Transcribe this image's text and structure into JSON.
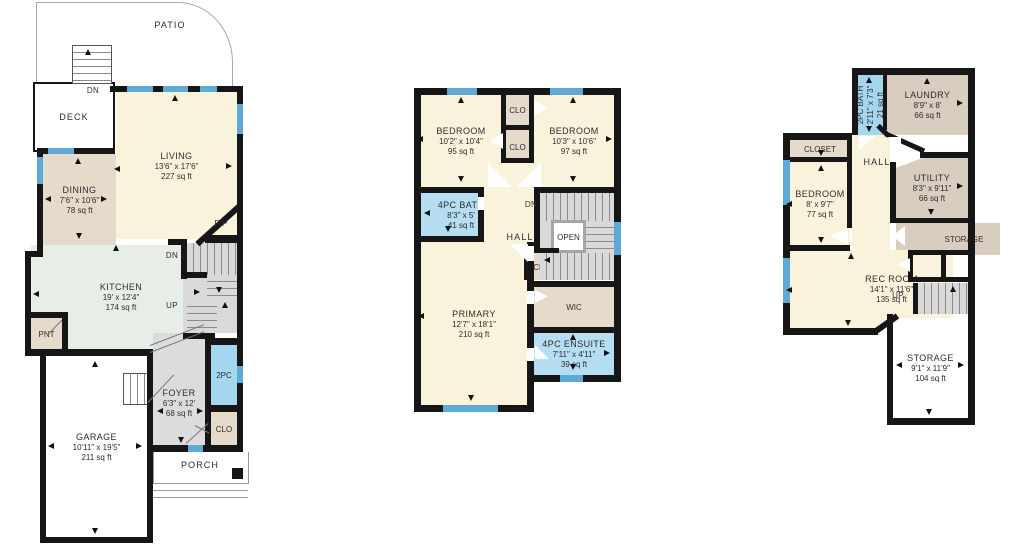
{
  "colors": {
    "wall": "#161616",
    "window": "#5FA9D6",
    "room_cream": "#FAF3DC",
    "room_tan": "#E6DACB",
    "room_taupe": "#D9CDBF",
    "room_kitchen": "#E7EEE7",
    "room_gray": "#DCDCDC",
    "room_blue": "#B5DEF2",
    "room_blue_dark": "#A5D6F0"
  },
  "main": {
    "patio": "PATIO",
    "deck": "DECK",
    "deck_dn": "DN",
    "stairs_dn": "DN",
    "stairs_up": "UP",
    "fireplace": "F/P",
    "pantry": "PNT",
    "powder_room": "2PC",
    "closet": "CLO",
    "porch": "PORCH",
    "rooms": {
      "living": {
        "name": "LIVING",
        "dims": "13'6\" x 17'6\"",
        "area": "227 sq ft"
      },
      "dining": {
        "name": "DINING",
        "dims": "7'6\" x 10'6\"",
        "area": "78 sq ft"
      },
      "kitchen": {
        "name": "KITCHEN",
        "dims": "19' x 12'4\"",
        "area": "174 sq ft"
      },
      "foyer": {
        "name": "FOYER",
        "dims": "6'3\" x 12'",
        "area": "68 sq ft"
      },
      "garage": {
        "name": "GARAGE",
        "dims": "10'11\" x 19'5\"",
        "area": "211 sq ft"
      }
    }
  },
  "upper": {
    "clo_top": "CLO",
    "clo_mid": "CLO",
    "clo_bottom": "CLO",
    "stairs_dn": "DN",
    "hall": "HALL",
    "open": "OPEN",
    "wic": "WIC",
    "rooms": {
      "bedroom_left": {
        "name": "BEDROOM",
        "dims": "10'2\" x 10'4\"",
        "area": "95 sq ft"
      },
      "bedroom_right": {
        "name": "BEDROOM",
        "dims": "10'3\" x 10'6\"",
        "area": "97 sq ft"
      },
      "bath": {
        "name": "4PC BATH",
        "dims": "8'3\" x 5'",
        "area": "41 sq ft"
      },
      "primary": {
        "name": "PRIMARY",
        "dims": "12'7\" x 18'1\"",
        "area": "210 sq ft"
      },
      "ensuite": {
        "name": "4PC ENSUITE",
        "dims": "7'11\" x 4'11\"",
        "area": "39 sq ft"
      }
    }
  },
  "basement": {
    "closet": "CLOSET",
    "hall": "HALL",
    "storage_small": "STORAGE",
    "clo": "CLO",
    "stairs_up": "UP",
    "rooms": {
      "bath": {
        "name": "2PC BATH",
        "dims": "2'11\" x 7'3\"",
        "area": "21 sq ft"
      },
      "laundry": {
        "name": "LAUNDRY",
        "dims": "8'9\" x 8'",
        "area": "66 sq ft"
      },
      "bedroom": {
        "name": "BEDROOM",
        "dims": "8' x 9'7\"",
        "area": "77 sq ft"
      },
      "utility": {
        "name": "UTILITY",
        "dims": "8'3\" x 9'11\"",
        "area": "66 sq ft"
      },
      "rec_room": {
        "name": "REC ROOM",
        "dims": "14'1\" x 11'6\"",
        "area": "135 sq ft"
      },
      "storage": {
        "name": "STORAGE",
        "dims": "9'1\" x 11'9\"",
        "area": "104 sq ft"
      }
    }
  }
}
